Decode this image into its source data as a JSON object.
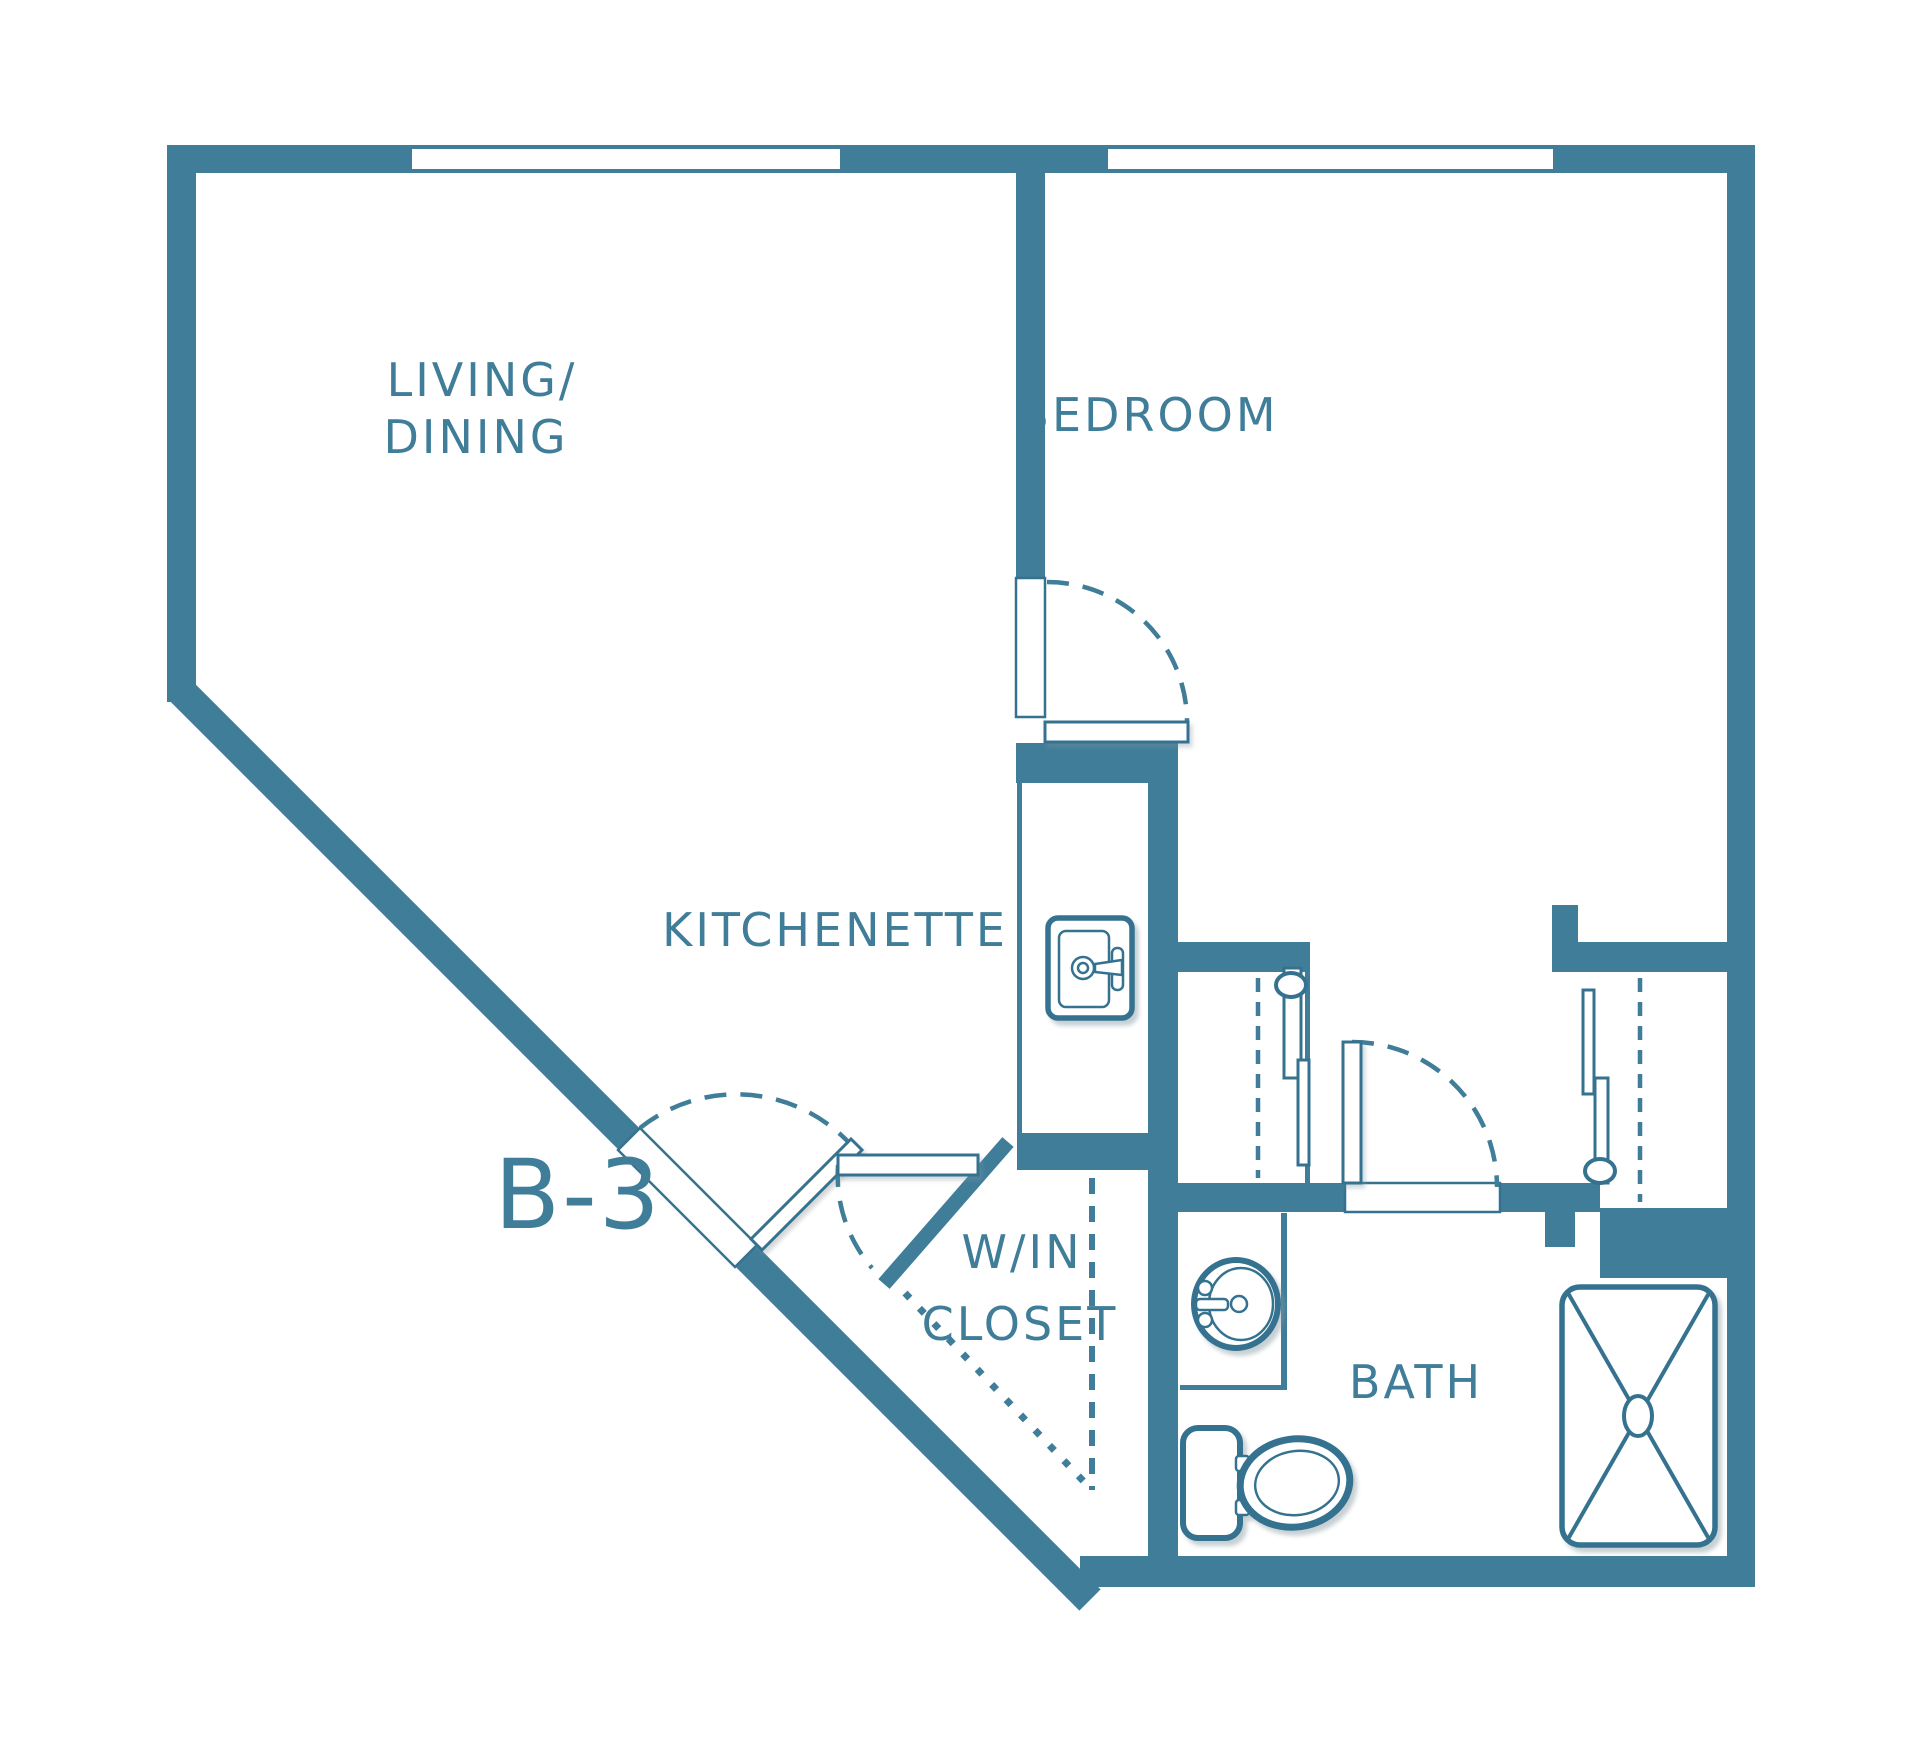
{
  "plan": {
    "unit_label": "B-3",
    "type": "floor-plan",
    "rooms": {
      "living_dining_line1": "LIVING/",
      "living_dining_line2": "DINING",
      "bedroom": "BEDROOM",
      "kitchenette": "KITCHENETTE",
      "walk_in_closet_line1": "W/IN",
      "walk_in_closet_line2": "CLOSET",
      "bath": "BATH"
    },
    "colors": {
      "wall": "#3f7d99",
      "fixture_outline": "#2f7190",
      "background": "#ffffff",
      "label": "#3f7d99"
    },
    "features": {
      "windows": 2,
      "swing_doors": 4,
      "closet_sliding_doors": 2,
      "fixtures": [
        "kitchen-sink",
        "bathroom-sink",
        "toilet",
        "shower"
      ]
    }
  }
}
